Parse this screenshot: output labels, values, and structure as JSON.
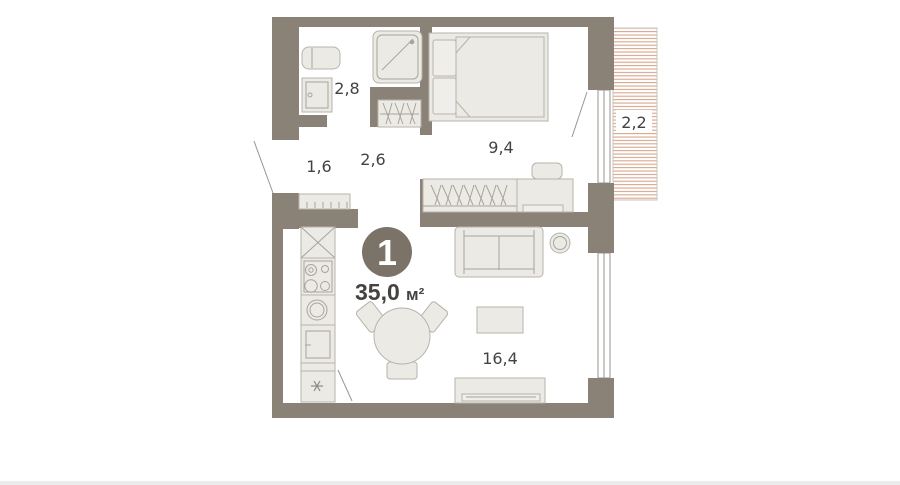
{
  "floorplan": {
    "badge": {
      "rooms_count": "1",
      "area_value": "35,0",
      "area_unit": "м²"
    },
    "room_labels": {
      "bathroom": "2,8",
      "hallway": "1,6",
      "corridor": "2,6",
      "bedroom": "9,4",
      "balcony": "2,2",
      "living_kitchen": "16,4"
    },
    "colors": {
      "wall": "#8a8177",
      "furniture_fill": "#eceae5",
      "furniture_stroke": "#b7b3aa",
      "balcony_hatch": "#d8a58b",
      "badge_fill": "#7b7268",
      "label_text": "#454340",
      "background": "#ffffff"
    }
  }
}
